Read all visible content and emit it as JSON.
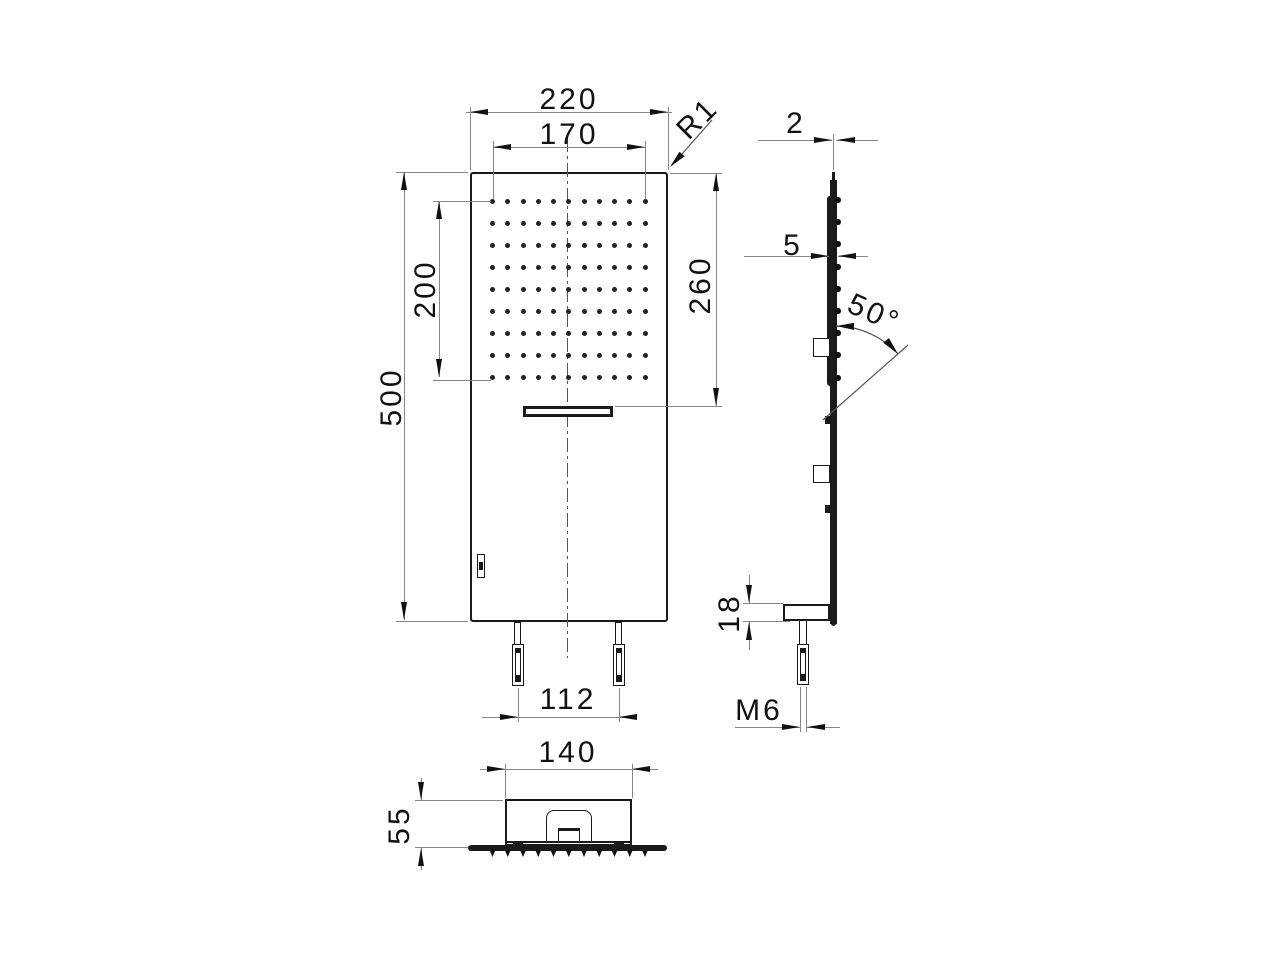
{
  "drawing": {
    "type": "technical-orthographic-drawing",
    "subject": "wall-mounted rain shower head",
    "front_view": {
      "dims": {
        "overall_width": "220",
        "spray_field_width": "170",
        "spray_field_height": "200",
        "overall_height": "500",
        "top_to_outlet": "260",
        "corner_radius": "R1",
        "stud_spacing": "112"
      },
      "spray_grid": {
        "rows": 9,
        "cols": 11
      }
    },
    "side_view": {
      "dims": {
        "panel_thickness": "2",
        "nozzle_thickness": "5",
        "spray_angle": "50°",
        "shelf_height": "18",
        "stud_thread": "M6"
      },
      "nozzle_rows": 9
    },
    "bottom_view": {
      "dims": {
        "housing_width": "140",
        "housing_depth": "55"
      },
      "nozzle_cols": 11
    },
    "colors": {
      "object_line": "#1a1a1a",
      "dimension_line": "#878787",
      "text": "#111111",
      "background": "#ffffff"
    }
  }
}
